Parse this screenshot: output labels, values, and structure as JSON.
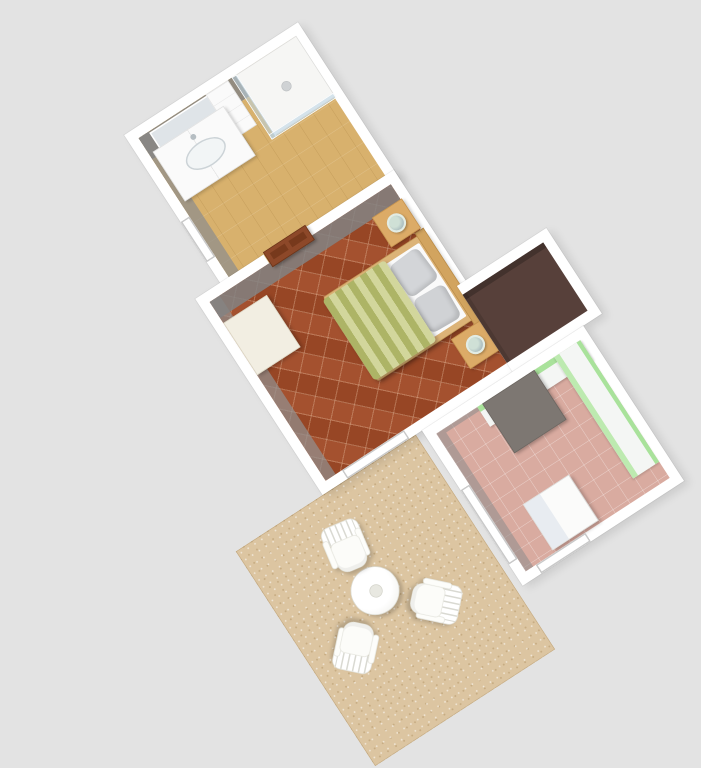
{
  "scene": {
    "type": "3d-floorplan-render",
    "description": "Top-down 3D rendering of a small apartment, plan rotated about -33 degrees",
    "background_color": "#e3e3e3",
    "visible_text": ""
  },
  "rooms": [
    {
      "id": "bathroom",
      "label": "Bathroom",
      "floor_color": "#d8b16d",
      "furniture": [
        "vanity-sink-cabinet",
        "wall-mirror",
        "shelf-unit",
        "glass-shower-cabin",
        "window"
      ]
    },
    {
      "id": "bedroom",
      "label": "Bedroom",
      "floor_color": "#a04a27",
      "furniture": [
        "double-bed",
        "nightstand-left",
        "nightstand-right",
        "table-lamp-left",
        "table-lamp-right",
        "dresser",
        "interior-door",
        "window"
      ]
    },
    {
      "id": "closet-nook",
      "label": "Closet nook",
      "floor_color": "#57403a",
      "furniture": [
        "dark-wardrobe"
      ]
    },
    {
      "id": "kitchen",
      "label": "Kitchen",
      "floor_color": "#d9aba0",
      "furniture": [
        "green-cabinet-run",
        "upper-cabinet-run",
        "dark-countertop",
        "white-table",
        "window",
        "terrace-door"
      ]
    },
    {
      "id": "terrace",
      "label": "Terrace",
      "floor_color": "#dcc5a1",
      "furniture": [
        "round-garden-table",
        "garden-chair-north",
        "garden-chair-southwest",
        "garden-chair-southeast"
      ]
    }
  ],
  "bed": {
    "duvet_stripe_dark": "#adb466",
    "duvet_stripe_light": "#d2d69c",
    "pillow_color": "#d3d5d8",
    "frame_wood": "#dcb377",
    "headboard_wood": "#d2a45f"
  },
  "kitchen_details": {
    "cabinet_green": "#a9e29b",
    "counter_white": "#f4f6f4",
    "dark_counter": "#7d7772",
    "table_color": "#fbfbfa"
  },
  "door": {
    "color": "#8d4829",
    "panel_color": "#77391c"
  },
  "terrace_set": {
    "chair_count": 3,
    "chair_color": "#ffffff",
    "table_shape": "round"
  },
  "palette": {
    "wall": "#ffffff",
    "wall_inner_face": "#b5b5b5",
    "nightstand_wood": "#dcab67",
    "lamp_glass": "#cfe0d6",
    "shower_glass": "#b9d4e4",
    "dresser_cream": "#f2eee2"
  }
}
